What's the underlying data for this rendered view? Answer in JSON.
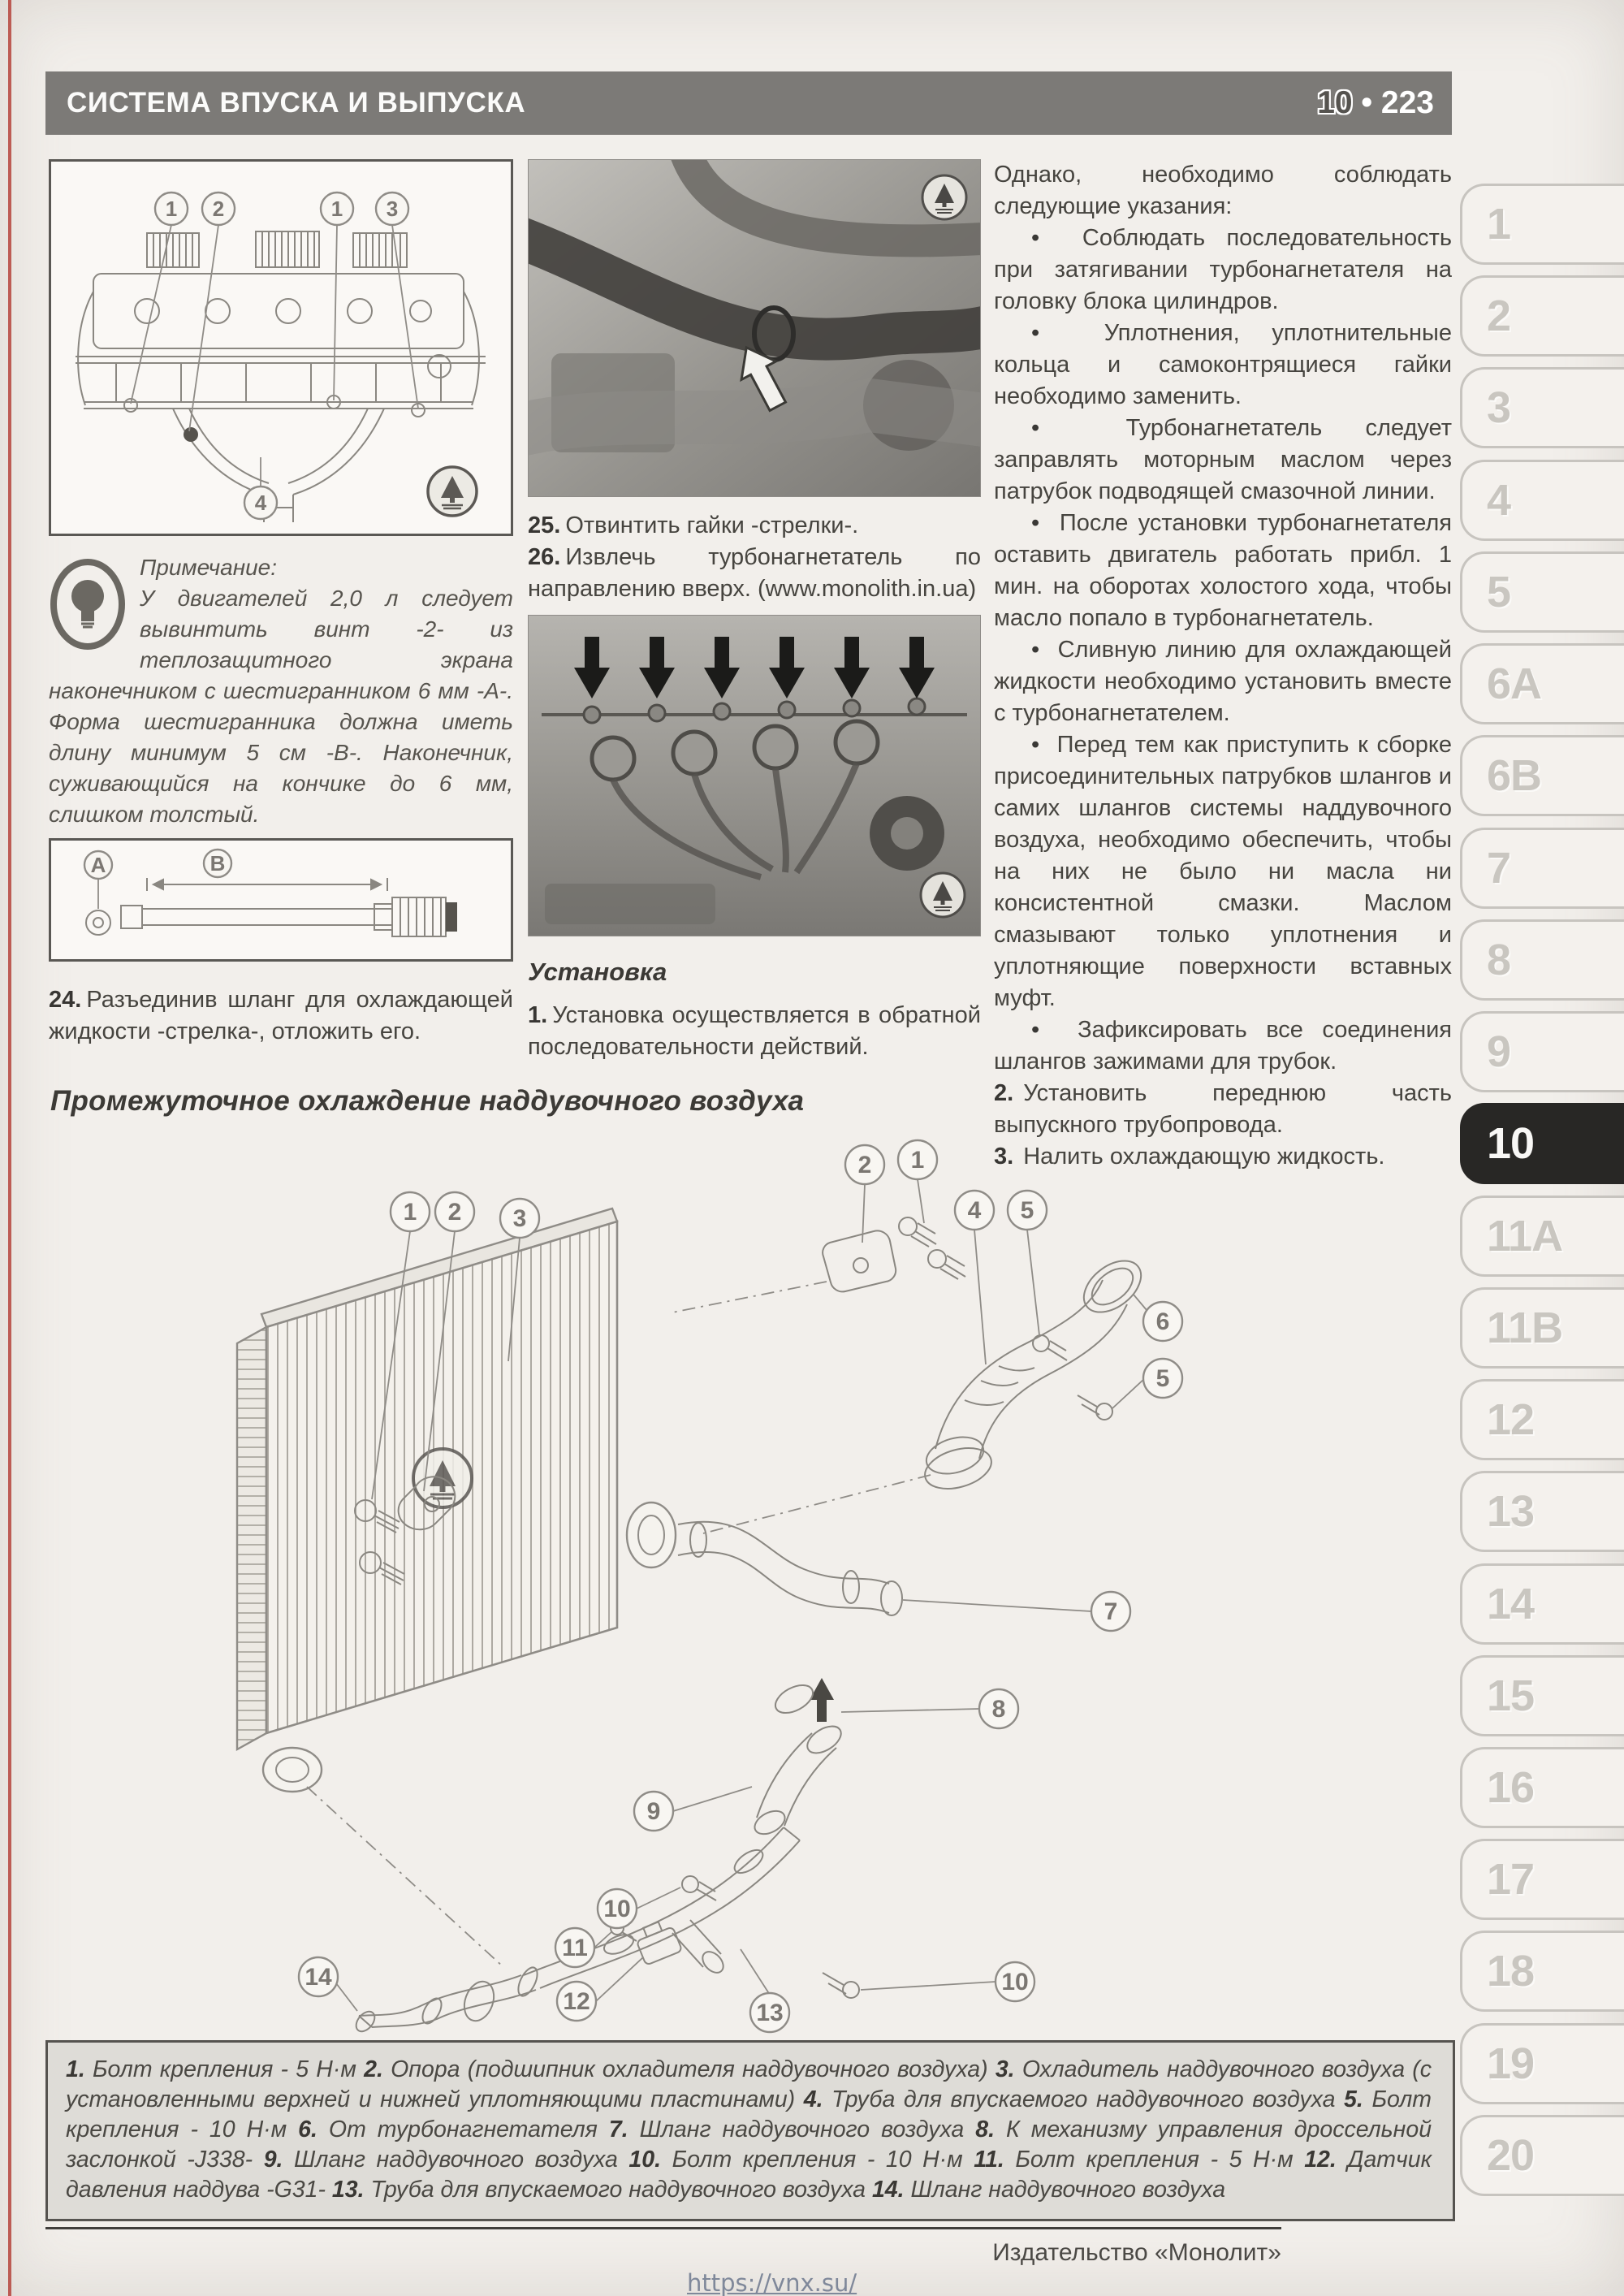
{
  "header": {
    "title": "СИСТЕМА ВПУСКА И ВЫПУСКА",
    "chapter": "10",
    "separator": "•",
    "page": "223"
  },
  "left": {
    "engine_callouts": [
      "1",
      "2",
      "1",
      "3",
      "4"
    ],
    "note_label": "Примечание:",
    "note_text": "У двигателей 2,0 л следует вывинтить винт -2- из теплозащитного экрана наконечником с шестигранником 6 мм -А-. Форма шестигранника должна иметь длину минимум 5 см -В-. Наконечник, суживающийся на кончике до 6 мм, слишком толстый.",
    "tool_callouts": [
      "A",
      "B"
    ],
    "step24_num": "24.",
    "step24_text": "Разъединив шланг для охлаждающей жидкости -стрелка-, отложить его."
  },
  "middle": {
    "step25_num": "25.",
    "step25_text": "Отвинтить гайки -стрелки-.",
    "step26_num": "26.",
    "step26_text": "Извлечь турбонагнетатель по направлению вверх. (www.monolith.in.ua)",
    "install_heading": "Установка",
    "step1_num": "1.",
    "step1_text": "Установка осуществляется в обратной последовательности действий."
  },
  "right": {
    "intro": "Однако, необходимо соблюдать следующие указания:",
    "bullets": [
      "Соблюдать последовательность при затягивании турбонагнетателя на головку блока цилиндров.",
      "Уплотнения, уплотнительные кольца и самоконтрящиеся гайки необходимо заменить.",
      "Турбонагнетатель следует заправлять моторным маслом через патрубок подводящей смазочной линии.",
      "После установки турбонагнетателя оставить двигатель работать прибл. 1 мин. на оборотах холостого хода, чтобы масло попало в турбонагнетатель.",
      "Сливную линию для охлаждающей жидкости необходимо установить вместе с турбонагнетателем.",
      "Перед тем как приступить к сборке присоединительных патрубков шлангов и самих шлангов системы наддувочного воздуха, необходимо обеспечить, чтобы на них не было ни масла ни консистентной смазки. Маслом смазывают только уплотнения и уплотняющие поверхности вставных муфт.",
      "Зафиксировать все соединения шлангов зажимами для трубок."
    ],
    "steps": [
      {
        "num": "2.",
        "text": "Установить переднюю часть выпускного трубопровода."
      },
      {
        "num": "3.",
        "text": "Налить охлаждающую жидкость."
      }
    ]
  },
  "section_heading": "Промежуточное охлаждение наддувочного воздуха",
  "diagram": {
    "callouts": [
      "1",
      "2",
      "3",
      "2",
      "1",
      "4",
      "5",
      "6",
      "5",
      "7",
      "8",
      "9",
      "10",
      "11",
      "12",
      "10",
      "13",
      "14"
    ]
  },
  "legend": {
    "items": [
      {
        "num": "1.",
        "text": "Болт крепления - 5 Н·м"
      },
      {
        "num": "2.",
        "text": "Опора (подшипник охладителя наддувочного воздуха)"
      },
      {
        "num": "3.",
        "text": "Охладитель наддувочного воздуха (с установленными верхней и нижней уплотняющими пластинами)"
      },
      {
        "num": "4.",
        "text": "Труба для впускаемого наддувочного воздуха"
      },
      {
        "num": "5.",
        "text": "Болт крепления - 10 Н·м"
      },
      {
        "num": "6.",
        "text": "От турбонагнетателя"
      },
      {
        "num": "7.",
        "text": "Шланг наддувочного воздуха"
      },
      {
        "num": "8.",
        "text": "К механизму управления дроссельной заслонкой -J338-"
      },
      {
        "num": "9.",
        "text": "Шланг наддувочного воздуха"
      },
      {
        "num": "10.",
        "text": "Болт крепления - 10 Н·м"
      },
      {
        "num": "11.",
        "text": "Болт крепления - 5 Н·м"
      },
      {
        "num": "12.",
        "text": "Датчик давления наддува -G31-"
      },
      {
        "num": "13.",
        "text": "Труба для впускаемого наддувочного воздуха"
      },
      {
        "num": "14.",
        "text": "Шланг наддувочного воздуха"
      }
    ]
  },
  "sidebar": {
    "tabs": [
      "1",
      "2",
      "3",
      "4",
      "5",
      "6A",
      "6B",
      "7",
      "8",
      "9",
      "10",
      "11A",
      "11B",
      "12",
      "13",
      "14",
      "15",
      "16",
      "17",
      "18",
      "19",
      "20"
    ],
    "active": "10"
  },
  "footer": {
    "publisher": "Издательство «Монолит»",
    "link": "https://vnx.su/"
  }
}
